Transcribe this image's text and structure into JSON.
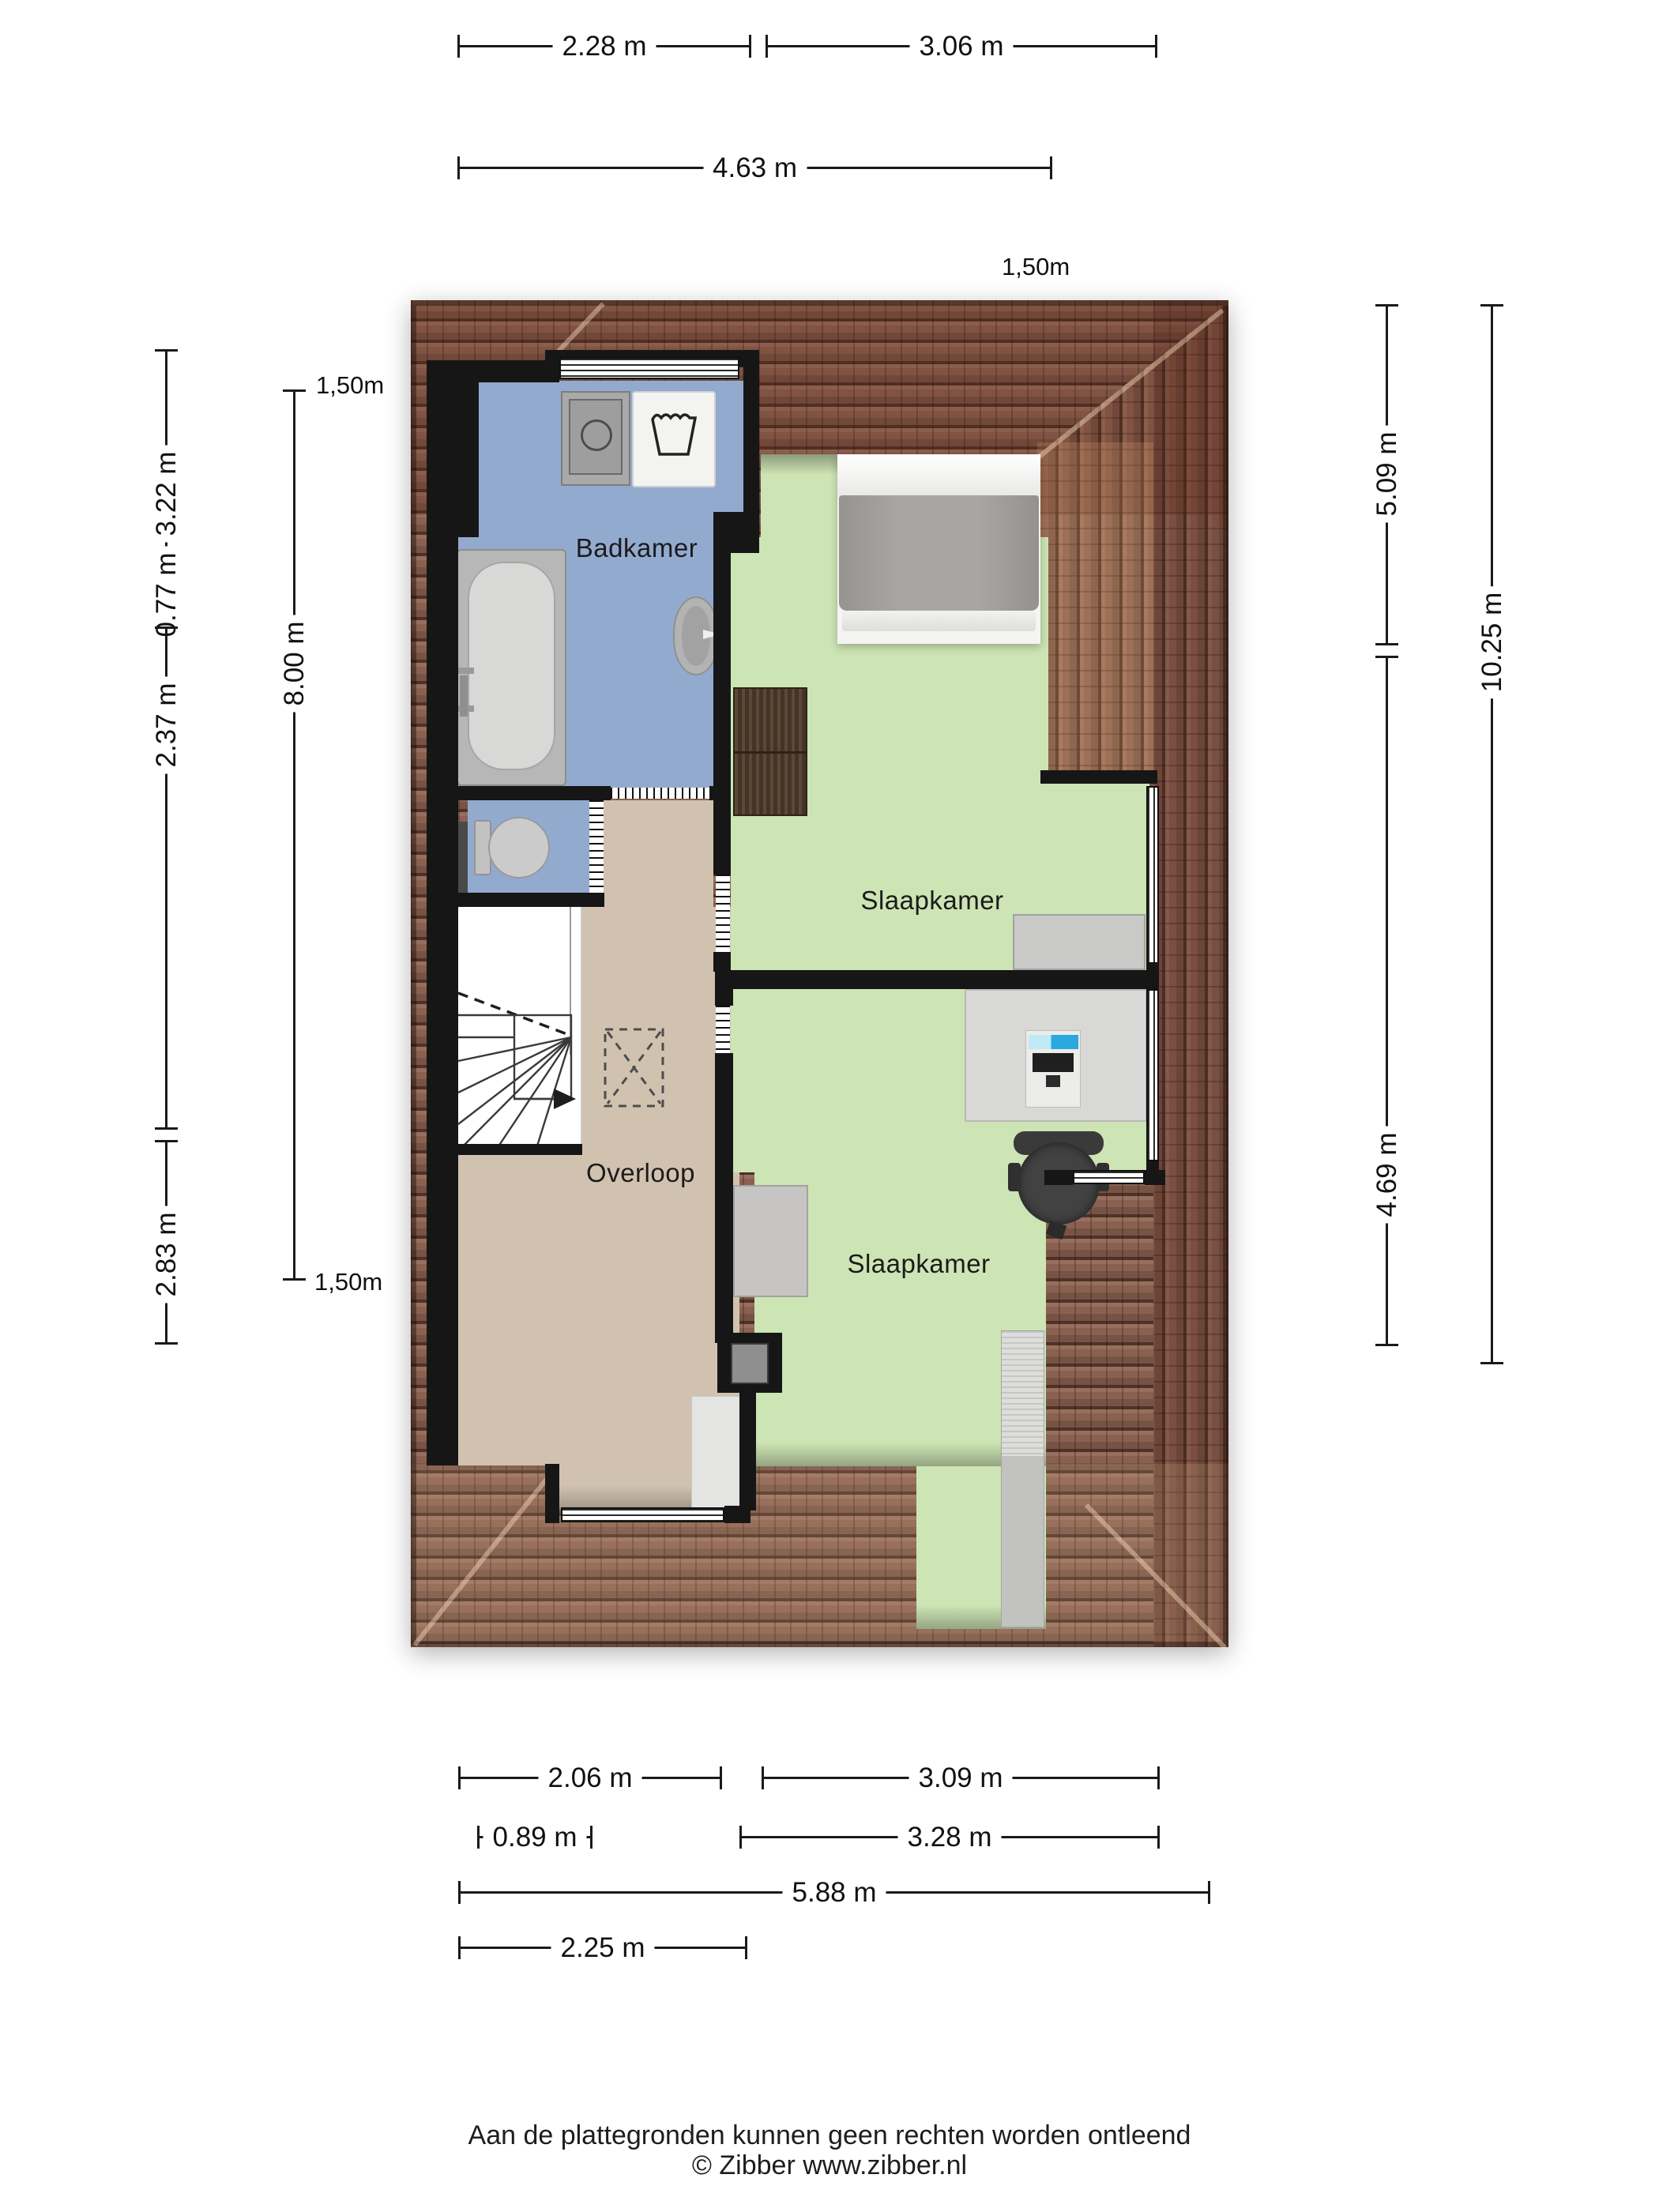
{
  "plan": {
    "type": "floorplan",
    "rooms": {
      "bathroom": {
        "label": "Badkamer"
      },
      "bedroom1": {
        "label": "Slaapkamer"
      },
      "bedroom2": {
        "label": "Slaapkamer"
      },
      "landing": {
        "label": "Overloop"
      }
    },
    "fixtures": [
      "washing-machine",
      "laundry-tub",
      "bathtub",
      "washbasin",
      "toilet",
      "stairs",
      "attic-hatch",
      "double-bed",
      "wardrobe",
      "dresser",
      "desk",
      "computer-monitor",
      "keyboard",
      "office-chair",
      "closet",
      "mat"
    ]
  },
  "dimensions": {
    "top": [
      {
        "label": "2.28 m"
      },
      {
        "label": "3.06 m"
      },
      {
        "label": "4.63 m"
      }
    ],
    "left": [
      {
        "label": "3.22 m"
      },
      {
        "label": "0.77 m"
      },
      {
        "label": "2.37 m"
      },
      {
        "label": "2.83 m"
      },
      {
        "label": "8.00 m"
      }
    ],
    "right": [
      {
        "label": "5.09 m"
      },
      {
        "label": "4.69 m"
      },
      {
        "label": "10.25 m"
      }
    ],
    "bottom": [
      {
        "label": "2.06 m"
      },
      {
        "label": "3.09 m"
      },
      {
        "label": "0.89 m"
      },
      {
        "label": "3.28 m"
      },
      {
        "label": "5.88 m"
      },
      {
        "label": "2.25 m"
      }
    ],
    "headroom_annotations": [
      {
        "label": "1,50m"
      },
      {
        "label": "1,50m"
      },
      {
        "label": "1,50m"
      }
    ]
  },
  "footer": {
    "disclaimer": "Aan de plattegronden kunnen geen rechten worden ontleend",
    "copyright": "© Zibber www.zibber.nl"
  },
  "colors": {
    "roof_base": "#8a6150",
    "roof_line": "#2e150d",
    "bathroom_floor": "#93aacf",
    "bedroom_floor": "#cde4b4",
    "landing_floor": "#d1c2b0",
    "wall": "#161616",
    "fixture_gray": "#bdbdbd",
    "wood": "#4e3a2a",
    "monitor_screen": "#2aa9e0",
    "text": "#1a1a1a"
  }
}
